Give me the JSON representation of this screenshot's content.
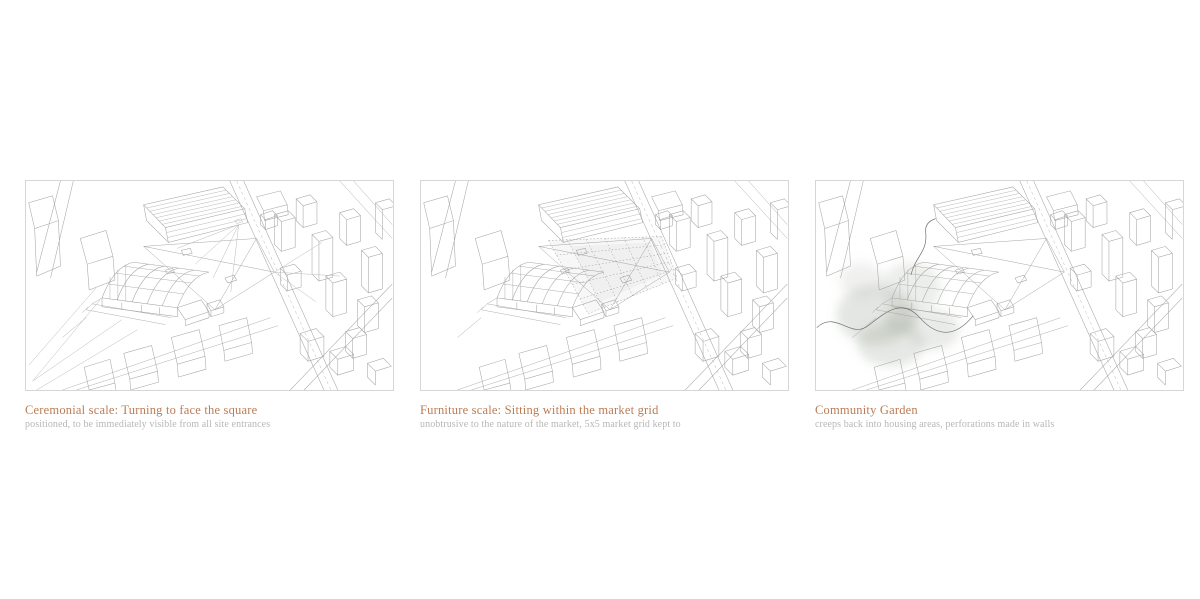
{
  "page": {
    "background": "#ffffff",
    "description_visible_elements": "three framed architectural sketches with captions"
  },
  "colors": {
    "caption_accent": "#bc7b53",
    "caption_subtitle": "#b7b7b7",
    "sketch_stroke": "#8f8f8f",
    "panel_border": "#d6d6d6",
    "garden_wash": "#93a08f"
  },
  "panels": [
    {
      "title": "Ceremonial scale: Turning to face the square",
      "subtitle": "positioned, to be immediately visible from all site entrances",
      "overlay": "sight-lines"
    },
    {
      "title": "Furniture scale: Sitting within the market grid",
      "subtitle": "unobtrusive to the nature of the market, 5x5 market grid kept to",
      "overlay": "market-grid"
    },
    {
      "title": "Community Garden",
      "subtitle": "creeps back into housing areas, perforations made in walls",
      "overlay": "garden-wash"
    }
  ]
}
